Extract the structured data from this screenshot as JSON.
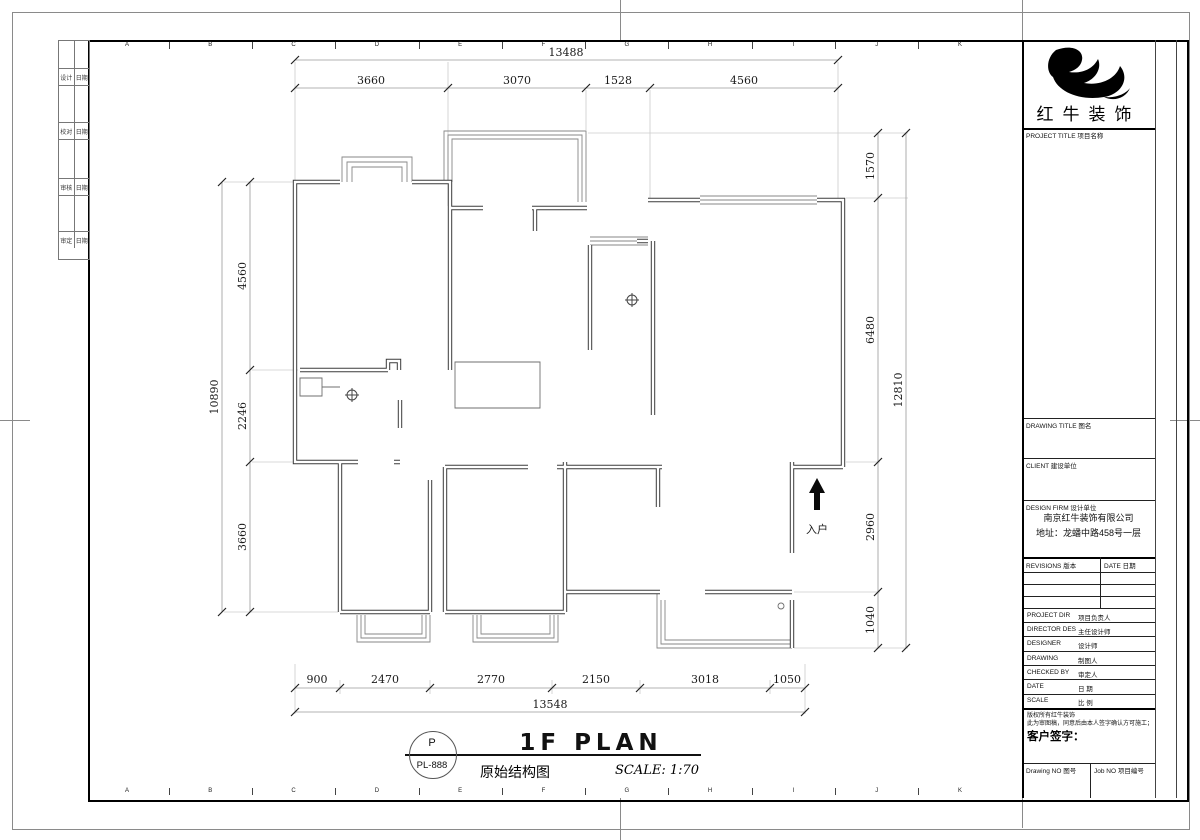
{
  "sheet": {
    "grid_letters": [
      "A",
      "B",
      "C",
      "D",
      "E",
      "F",
      "G",
      "H",
      "I",
      "J",
      "K"
    ],
    "signature_rows": [
      {
        "l": "设计",
        "r": "日期"
      },
      {
        "l": "校对",
        "r": "日期"
      },
      {
        "l": "审核",
        "r": "日期"
      },
      {
        "l": "审定",
        "r": "日期"
      }
    ]
  },
  "plan": {
    "entry_label": "入户",
    "dims": {
      "top_total": "13488",
      "top_segments": [
        "3660",
        "3070",
        "1528",
        "4560"
      ],
      "bottom_total": "13548",
      "bottom_segments": [
        "900",
        "2470",
        "2770",
        "2150",
        "3018",
        "1050"
      ],
      "left_total": "10890",
      "left_segments": [
        "4560",
        "2246",
        "3660"
      ],
      "right_total": "12810",
      "right_segments": [
        "1570",
        "6480",
        "2960",
        "1040"
      ]
    }
  },
  "titlemark": {
    "badge_top": "P",
    "badge_bottom": "PL-888",
    "title": "1F PLAN",
    "subtitle": "原始结构图",
    "scale": "SCALE: 1:70"
  },
  "titleblock": {
    "logo_text": "红牛装饰",
    "project_title_label": "PROJECT TITLE 项目名称",
    "drawing_title_label": "DRAWING TITLE 图名",
    "client_label": "CLIENT 建设单位",
    "design_firm_label": "DESIGN FIRM 设计单位",
    "company_name": "南京红牛装饰有限公司",
    "company_address": "地址：龙蟠中路458号一层",
    "revisions_label": "REVISIONS 版本",
    "revisions_date_label": "DATE 日期",
    "staff_rows": [
      {
        "en": "PROJECT DIR",
        "cn": "项目负责人"
      },
      {
        "en": "DIRECTOR DES",
        "cn": "主任设计师"
      },
      {
        "en": "DESIGNER",
        "cn": "设计师"
      },
      {
        "en": "DRAWING",
        "cn": "制图人"
      },
      {
        "en": "CHECKED BY",
        "cn": "审定人"
      },
      {
        "en": "DATE",
        "cn": "日  期"
      },
      {
        "en": "SCALE",
        "cn": "比  例"
      }
    ],
    "copyright_line1": "版权所有红牛装饰",
    "copyright_line2": "此为审图稿，同意后由本人签字确认方可施工；",
    "client_sign_label": "客户签字：",
    "drawing_no_label": "Drawing NO 图号",
    "job_no_label": "Job NO 项目编号"
  }
}
